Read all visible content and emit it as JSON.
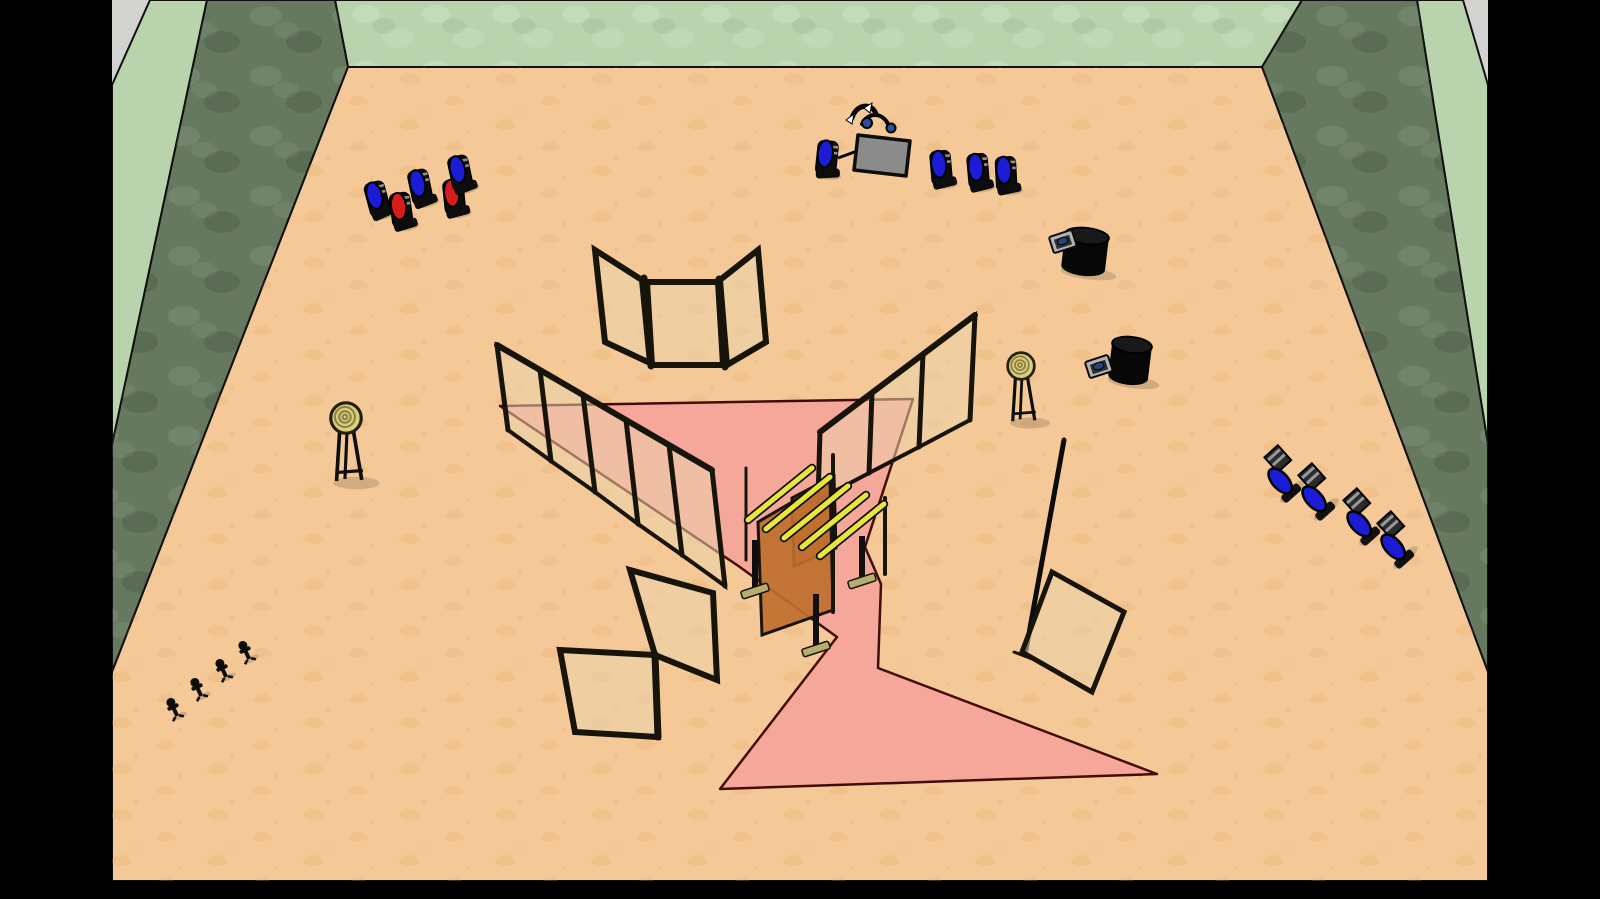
{
  "viewport": {
    "letterbox": "#000000",
    "background": "#d2d2d0"
  },
  "room": {
    "wall_light": "#b9d4ad",
    "wall_dark": "#66795f",
    "wall_edge": "#101010",
    "floor": "#f5c997",
    "floor_motif": "#e2a265"
  },
  "course": {
    "fill": "#f5a79a",
    "outline": "#430c09"
  },
  "panels": {
    "fill": "rgba(233,209,172,0.55)",
    "frame": "#17140c"
  },
  "gate": {
    "panel_front_fill": "#bf6f2e",
    "panel_back_fill": "#b05f1f",
    "bar_yellow": "#e9e63a",
    "bar_outline": "#0d0d0d",
    "post_khaki": "#b5ae6e",
    "bars": [
      {
        "x1": 748,
        "y1": 520,
        "x2": 812,
        "y2": 468
      },
      {
        "x1": 766,
        "y1": 529,
        "x2": 830,
        "y2": 477
      },
      {
        "x1": 784,
        "y1": 538,
        "x2": 848,
        "y2": 486
      },
      {
        "x1": 802,
        "y1": 547,
        "x2": 866,
        "y2": 495
      },
      {
        "x1": 820,
        "y1": 556,
        "x2": 884,
        "y2": 504
      }
    ]
  },
  "figures": {
    "colors": {
      "blue": "#1c1cd6",
      "red": "#d61c1c",
      "body": "#0d0d0d",
      "slab": "#2b2b2b",
      "stripe": "#999999"
    },
    "standing": [
      {
        "x": 377,
        "y": 198,
        "rot": -15,
        "color": "blue"
      },
      {
        "x": 401,
        "y": 209,
        "rot": -8,
        "color": "red"
      },
      {
        "x": 420,
        "y": 186,
        "rot": -12,
        "color": "blue"
      },
      {
        "x": 454,
        "y": 196,
        "rot": -6,
        "color": "red"
      },
      {
        "x": 460,
        "y": 172,
        "rot": -12,
        "color": "blue"
      },
      {
        "x": 827,
        "y": 157,
        "rot": 6,
        "color": "blue"
      },
      {
        "x": 941,
        "y": 167,
        "rot": -5,
        "color": "blue"
      },
      {
        "x": 978,
        "y": 170,
        "rot": -5,
        "color": "blue"
      },
      {
        "x": 1006,
        "y": 173,
        "rot": -3,
        "color": "blue"
      }
    ],
    "fallen": [
      {
        "x": 1283,
        "y": 481,
        "rot": -42
      },
      {
        "x": 1317,
        "y": 499,
        "rot": -42
      },
      {
        "x": 1362,
        "y": 524,
        "rot": -42
      },
      {
        "x": 1396,
        "y": 547,
        "rot": -42
      }
    ],
    "mini": [
      {
        "x": 245,
        "y": 650,
        "rot": -25
      },
      {
        "x": 222,
        "y": 668,
        "rot": -25
      },
      {
        "x": 197,
        "y": 687,
        "rot": -25
      },
      {
        "x": 173,
        "y": 707,
        "rot": -25
      }
    ]
  },
  "equipment": {
    "target_face": "#d9cf7c",
    "target_ring": "#8e8148",
    "cylinder": "#070707",
    "pad_metal": "#b3b3b3",
    "pad_button": "#27417b",
    "board": {
      "fill": "#8b8b8b",
      "joint_blue": "#2a4f9b"
    },
    "targets": [
      {
        "x": 346,
        "y": 418,
        "s": 1.05
      },
      {
        "x": 1021,
        "y": 366,
        "s": 0.92
      }
    ],
    "cylinders": [
      {
        "x": 1087,
        "y": 236,
        "rx": 22,
        "h": 32
      },
      {
        "x": 1132,
        "y": 345,
        "rx": 20,
        "h": 32
      }
    ],
    "pads": [
      {
        "x": 1063,
        "y": 242
      },
      {
        "x": 1099,
        "y": 367
      }
    ]
  },
  "inventory": [
    "green-walled room with tan patterned floor",
    "pink zigzag course outline on floor",
    "three-panel folding screen (top center)",
    "five-panel translucent fence (left)",
    "three-panel translucent fence (right)",
    "two-panel folding screen (bottom center)",
    "single tilted panel with tall pole (right)",
    "gate obstacle with five yellow crossbars and orange panels",
    "two round targets on black stands",
    "two black cylinders with button pads",
    "gray board with climbing linkage figure",
    "seven standing blue pin figures",
    "two standing red pin figures",
    "four fallen blue figures (right side)",
    "four small black figures (bottom left)"
  ]
}
